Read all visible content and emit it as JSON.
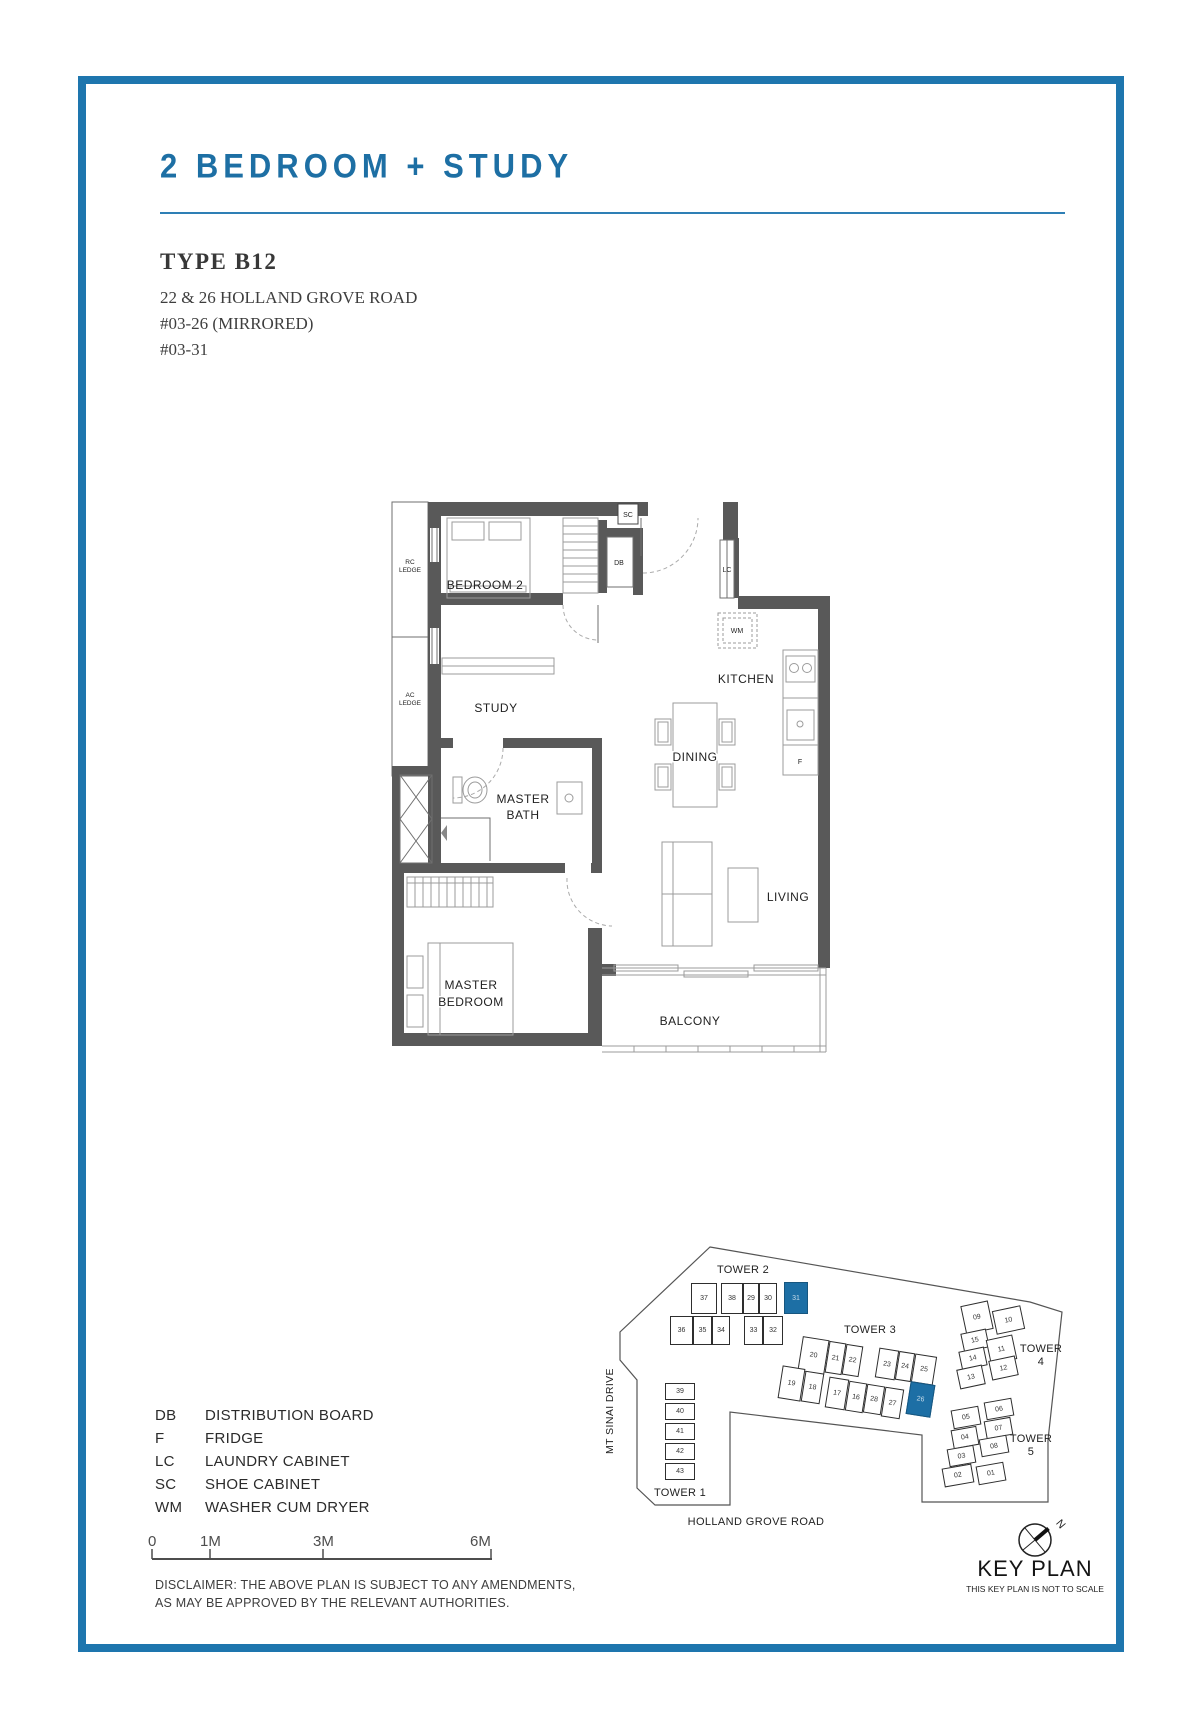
{
  "page": {
    "title": "2 BEDROOM + STUDY",
    "type_label": "TYPE B12",
    "address_lines": [
      "22 & 26 HOLLAND GROVE ROAD",
      "#03-26 (MIRRORED)",
      "#03-31"
    ]
  },
  "floorplan": {
    "rooms": {
      "bedroom2": "BEDROOM 2",
      "study": "STUDY",
      "kitchen": "KITCHEN",
      "dining": "DINING",
      "living": "LIVING",
      "balcony": "BALCONY",
      "master_bath1": "MASTER",
      "master_bath2": "BATH",
      "master_bed1": "MASTER",
      "master_bed2": "BEDROOM"
    },
    "tags": {
      "sc": "SC",
      "db": "DB",
      "lc": "LC",
      "wm": "WM",
      "f": "F"
    },
    "ledges": {
      "rc1": "RC",
      "rc2": "LEDGE",
      "ac1": "AC",
      "ac2": "LEDGE"
    }
  },
  "legend": {
    "items": [
      {
        "abbr": "DB",
        "desc": "DISTRIBUTION BOARD"
      },
      {
        "abbr": "F",
        "desc": "FRIDGE"
      },
      {
        "abbr": "LC",
        "desc": "LAUNDRY CABINET"
      },
      {
        "abbr": "SC",
        "desc": "SHOE CABINET"
      },
      {
        "abbr": "WM",
        "desc": "WASHER CUM DRYER"
      }
    ]
  },
  "scalebar": {
    "labels": [
      "0",
      "1M",
      "3M",
      "6M"
    ]
  },
  "disclaimer": {
    "line1": "DISCLAIMER: THE ABOVE PLAN IS SUBJECT TO ANY AMENDMENTS,",
    "line2": "AS MAY BE APPROVED BY THE RELEVANT AUTHORITIES."
  },
  "keyplan": {
    "towers": {
      "t1": "TOWER 1",
      "t2": "TOWER 2",
      "t3": "TOWER 3",
      "t4a": "TOWER",
      "t4b": "4",
      "t5a": "TOWER",
      "t5b": "5"
    },
    "roads": {
      "mt_sinai": "MT SINAI DRIVE",
      "holland": "HOLLAND GROVE ROAD"
    },
    "title": "KEY PLAN",
    "subtitle": "THIS KEY PLAN IS NOT TO SCALE",
    "north": "N",
    "units": [
      {
        "label": "37"
      },
      {
        "label": "38"
      },
      {
        "label": "29"
      },
      {
        "label": "30"
      },
      {
        "label": "31",
        "hl": true
      },
      {
        "label": "36"
      },
      {
        "label": "35"
      },
      {
        "label": "34"
      },
      {
        "label": "33"
      },
      {
        "label": "32"
      },
      {
        "label": "20"
      },
      {
        "label": "21"
      },
      {
        "label": "22"
      },
      {
        "label": "23"
      },
      {
        "label": "24"
      },
      {
        "label": "25"
      },
      {
        "label": "19"
      },
      {
        "label": "18"
      },
      {
        "label": "17"
      },
      {
        "label": "16"
      },
      {
        "label": "28"
      },
      {
        "label": "27"
      },
      {
        "label": "26",
        "hl": true
      },
      {
        "label": "09"
      },
      {
        "label": "10"
      },
      {
        "label": "15"
      },
      {
        "label": "11"
      },
      {
        "label": "14"
      },
      {
        "label": "12"
      },
      {
        "label": "13"
      },
      {
        "label": "06"
      },
      {
        "label": "05"
      },
      {
        "label": "07"
      },
      {
        "label": "04"
      },
      {
        "label": "08"
      },
      {
        "label": "03"
      },
      {
        "label": "02"
      },
      {
        "label": "01"
      },
      {
        "label": "39"
      },
      {
        "label": "40"
      },
      {
        "label": "41"
      },
      {
        "label": "42"
      },
      {
        "label": "43"
      }
    ]
  },
  "colors": {
    "accent": "#1e76ae",
    "highlight": "#1d6fa5"
  }
}
